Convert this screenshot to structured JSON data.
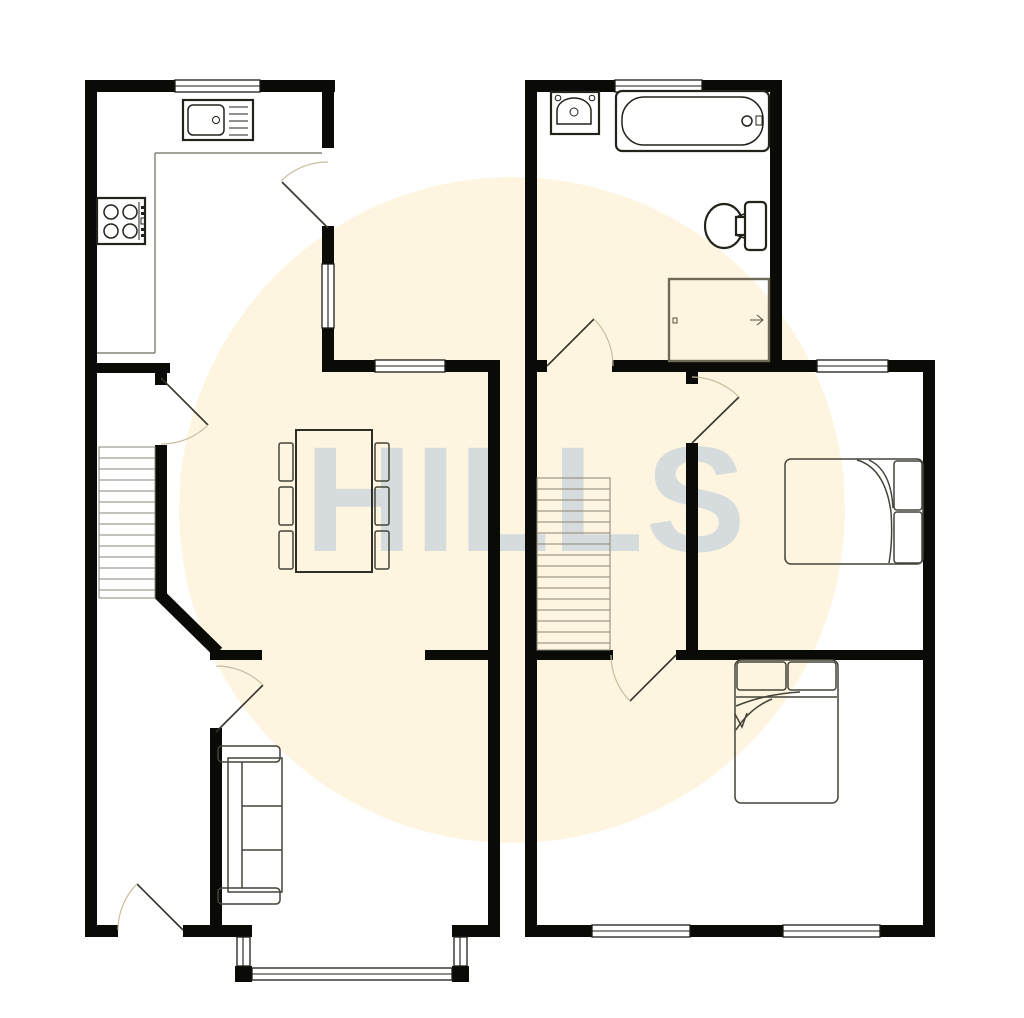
{
  "watermark": {
    "text": "HILLS"
  },
  "colors": {
    "background": "#ffffff",
    "circle": "#fdf5df",
    "watermark": "#b9c7dd",
    "wall": "#0a0a06"
  },
  "diagram": {
    "type": "floor-plan",
    "floors": [
      {
        "name": "ground-floor",
        "position": "left",
        "rooms": [
          "kitchen",
          "dining-room",
          "hallway-with-stairs",
          "living-room"
        ],
        "fixtures": [
          "kitchen-sink",
          "hob",
          "worktop",
          "staircase",
          "dining-table",
          "six-chairs",
          "sofa",
          "bay-window"
        ],
        "door_symbols": 5,
        "window_symbols": 6
      },
      {
        "name": "first-floor",
        "position": "right",
        "rooms": [
          "bathroom",
          "landing-with-stairs",
          "bedroom-1",
          "bedroom-2"
        ],
        "fixtures": [
          "wash-basin",
          "bath-tub",
          "toilet",
          "airing-cupboard",
          "staircase",
          "single-bed",
          "double-bed"
        ],
        "door_symbols": 3,
        "window_symbols": 5
      }
    ]
  }
}
